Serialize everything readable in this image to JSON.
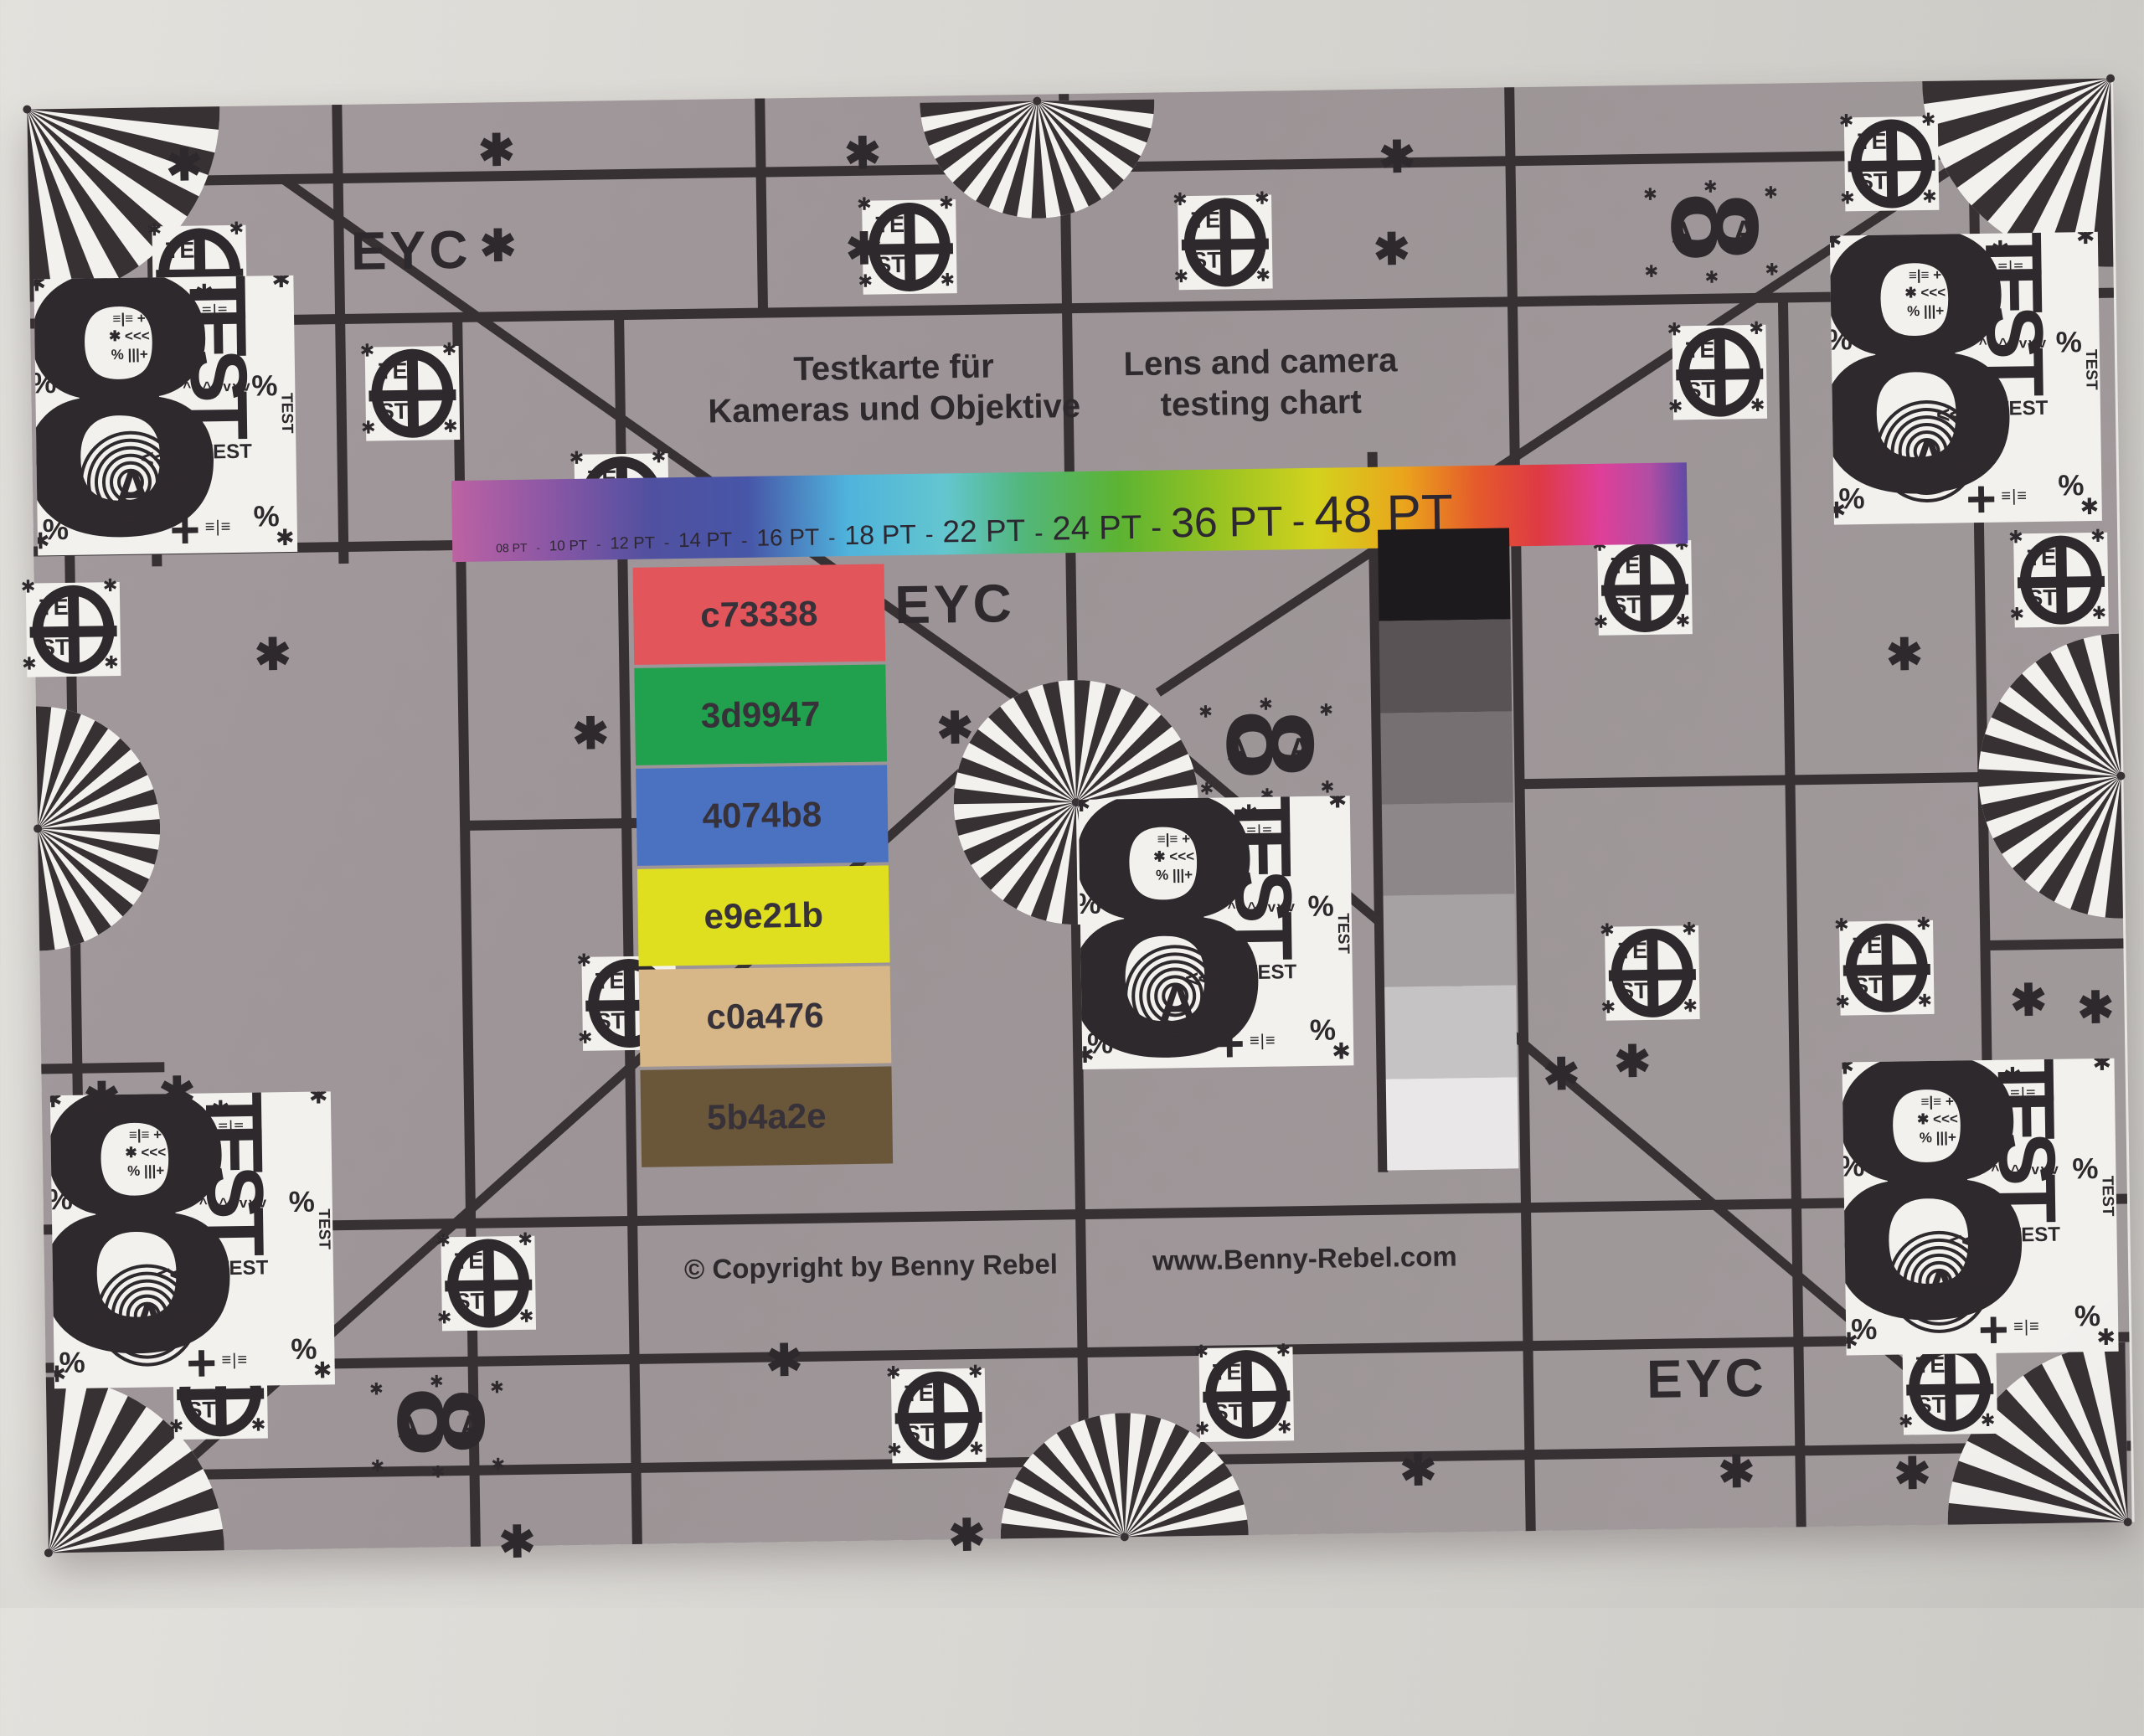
{
  "scene": {
    "wall_color_top": "#e3e1dc",
    "wall_color_bottom": "#cac8c3"
  },
  "chart": {
    "background": "#9c9496",
    "line_color": "#373134",
    "white": "#f3f1ee",
    "ink": "#2e292c",
    "eyc_label": "EYC",
    "title_de_line1": "Testkarte für",
    "title_de_line2": "Kameras und Objektive",
    "title_en_line1": "Lens and camera",
    "title_en_line2": "testing chart",
    "font_bar": {
      "labels": [
        "08 PT",
        "10 PT",
        "12 PT",
        "14 PT",
        "16 PT",
        "18 PT",
        "22 PT",
        "24 PT",
        "36 PT",
        "48 PT"
      ],
      "separator": "-",
      "sizes": [
        14,
        17,
        20,
        24,
        28,
        32,
        37,
        40,
        50,
        62
      ],
      "gradient_stops": [
        "#bd62a3 0%",
        "#8a57a5 8%",
        "#5150a0 16%",
        "#4756a8 24%",
        "#4fb3dc 32%",
        "#63c6cf 40%",
        "#52b77e 46%",
        "#5cb332 54%",
        "#97c322 62%",
        "#d3d21d 70%",
        "#eaa51c 77%",
        "#e55a2b 83%",
        "#de3a44 88%",
        "#df3f98 93%",
        "#b14da4 97%",
        "#5f4aa5 100%"
      ]
    },
    "color_patches": [
      {
        "label": "c73338",
        "color": "#e2555a"
      },
      {
        "label": "3d9947",
        "color": "#21a04d"
      },
      {
        "label": "4074b8",
        "color": "#4a72c0"
      },
      {
        "label": "e9e21b",
        "color": "#dfdf20"
      },
      {
        "label": "c0a476",
        "color": "#d7b787"
      },
      {
        "label": "5b4a2e",
        "color": "#6a5639"
      }
    ],
    "grayscale_steps": [
      "#1d1a1d",
      "#595356",
      "#767072",
      "#8d878a",
      "#a6a1a3",
      "#c6c3c4",
      "#e9e7e8"
    ],
    "copyright_text": "© Copyright by Benny Rebel",
    "website_text": "www.Benny-Rebel.com",
    "marks": {
      "test_upper": "TE",
      "test_lower": "ST",
      "test_word": "TEST",
      "eight": "8",
      "letter_a": "A",
      "percent": "%",
      "asterisk": "✱",
      "cross": "+",
      "arrows_up": "^^^",
      "arrows_down": "vvv",
      "arrows_left": "<<<",
      "barcode": "≡|≡",
      "clutter": [
        "≡|≡ +",
        "✱ <<<",
        "% |||+"
      ]
    },
    "decor": {
      "grid_v": [
        [
          43,
          528,
          1183
        ],
        [
          147,
          0,
          548
        ],
        [
          370,
          0,
          548
        ],
        [
          510,
          256,
          1724
        ],
        [
          703,
          256,
          1724
        ],
        [
          875,
          0,
          256
        ],
        [
          1238,
          0,
          1724
        ],
        [
          1770,
          0,
          1724
        ],
        [
          2093,
          256,
          1724
        ],
        [
          2323,
          0,
          1724
        ],
        [
          1600,
          433,
          1293
        ]
      ],
      "grid_h": [
        [
          88,
          0,
          2488
        ],
        [
          256,
          0,
          2488
        ],
        [
          528,
          0,
          512
        ],
        [
          863,
          510,
          717
        ],
        [
          832,
          1770,
          2323
        ],
        [
          1033,
          2323,
          2488
        ],
        [
          1146,
          0,
          147
        ],
        [
          1338,
          0,
          2488
        ],
        [
          1503,
          0,
          2488
        ],
        [
          1633,
          0,
          2488
        ]
      ],
      "diagonals": [
        [
          305,
          88,
          1180,
          726
        ],
        [
          95,
          1680,
          1140,
          776
        ],
        [
          1340,
          716,
          2323,
          88
        ],
        [
          1350,
          776,
          2400,
          1690
        ]
      ],
      "fans": [
        [
          0,
          0,
          230,
          0,
          90
        ],
        [
          2488,
          0,
          225,
          90,
          180
        ],
        [
          0,
          1724,
          210,
          270,
          360
        ],
        [
          2483,
          1724,
          215,
          180,
          270
        ],
        [
          1206,
          8,
          140,
          0,
          180
        ],
        [
          1285,
          1724,
          148,
          180,
          360
        ],
        [
          0,
          859,
          146,
          270,
          450
        ],
        [
          2488,
          833,
          170,
          90,
          270
        ],
        [
          1240,
          846,
          146,
          0,
          360
        ]
      ],
      "test_circles": [
        [
          203,
          198
        ],
        [
          455,
          346
        ],
        [
          1051,
          180
        ],
        [
          1428,
          180
        ],
        [
          2225,
          98
        ],
        [
          2016,
          344
        ],
        [
          46,
          622
        ],
        [
          703,
          478
        ],
        [
          1923,
          600
        ],
        [
          2420,
          598
        ],
        [
          703,
          1078
        ],
        [
          1925,
          1060
        ],
        [
          2205,
          1058
        ],
        [
          208,
          1535
        ],
        [
          530,
          1410
        ],
        [
          1065,
          1576
        ],
        [
          1433,
          1556
        ],
        [
          2273,
          1560
        ]
      ],
      "mini_eights": [
        [
          2012,
          176
        ],
        [
          1472,
          786
        ],
        [
          470,
          1580
        ]
      ],
      "blocks": [
        [
          5,
          203,
          310,
          330
        ],
        [
          2150,
          183,
          320,
          345
        ],
        [
          10,
          1178,
          335,
          350
        ],
        [
          2150,
          1170,
          325,
          350
        ],
        [
          1243,
          843,
          324,
          322
        ]
      ],
      "asterisks": [
        [
          165,
          40
        ],
        [
          538,
          28
        ],
        [
          975,
          38
        ],
        [
          1613,
          52
        ],
        [
          538,
          142
        ],
        [
          975,
          152
        ],
        [
          1605,
          162
        ],
        [
          262,
          626
        ],
        [
          640,
          726
        ],
        [
          1075,
          726
        ],
        [
          50,
          1153
        ],
        [
          140,
          1148
        ],
        [
          1793,
          1150
        ],
        [
          1878,
          1136
        ],
        [
          2210,
          655
        ],
        [
          2352,
          1070
        ],
        [
          2432,
          1080
        ],
        [
          860,
          1478
        ],
        [
          1615,
          1620
        ],
        [
          1995,
          1628
        ],
        [
          538,
          1690
        ],
        [
          1075,
          1690
        ],
        [
          2205,
          1633
        ]
      ]
    }
  }
}
